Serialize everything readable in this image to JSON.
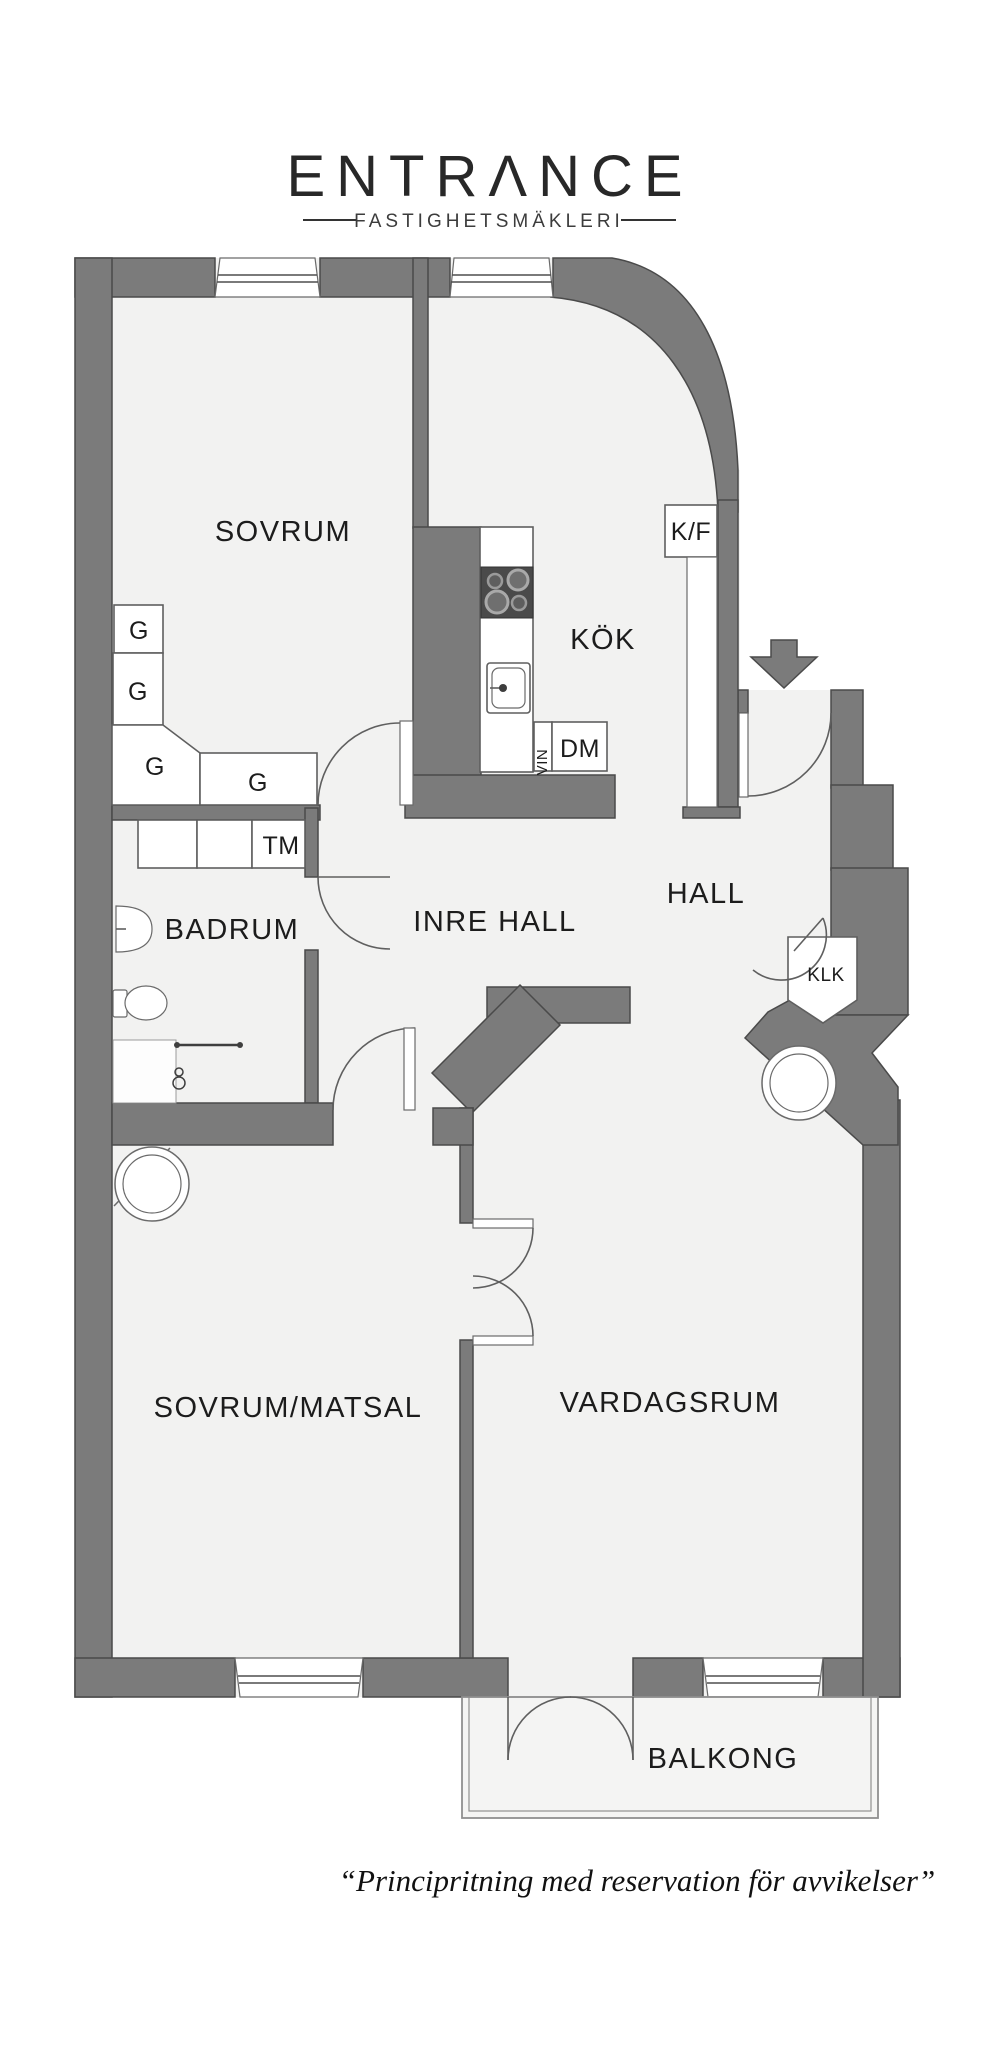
{
  "logo": {
    "brand": "ENTRΛNCE",
    "tagline": "FASTIGHETSMÄKLERI"
  },
  "rooms": {
    "sovrum": "SOVRUM",
    "kok": "KÖK",
    "hall": "HALL",
    "inre_hall": "INRE HALL",
    "badrum": "BADRUM",
    "sovrum_matsal": "SOVRUM/MATSAL",
    "vardagsrum": "VARDAGSRUM",
    "balkong": "BALKONG"
  },
  "fixtures": {
    "kf": "K/F",
    "dm": "DM",
    "vin": "VIN",
    "tm": "TM",
    "klk": "KLK",
    "garderob": "G"
  },
  "footer": {
    "disclaimer": "“Principritning med reservation för avvikelser”"
  },
  "colors": {
    "wall": "#7b7b7b",
    "floor": "#f2f2f1",
    "outline": "#4a4a4a",
    "text": "#1c1c1c"
  }
}
